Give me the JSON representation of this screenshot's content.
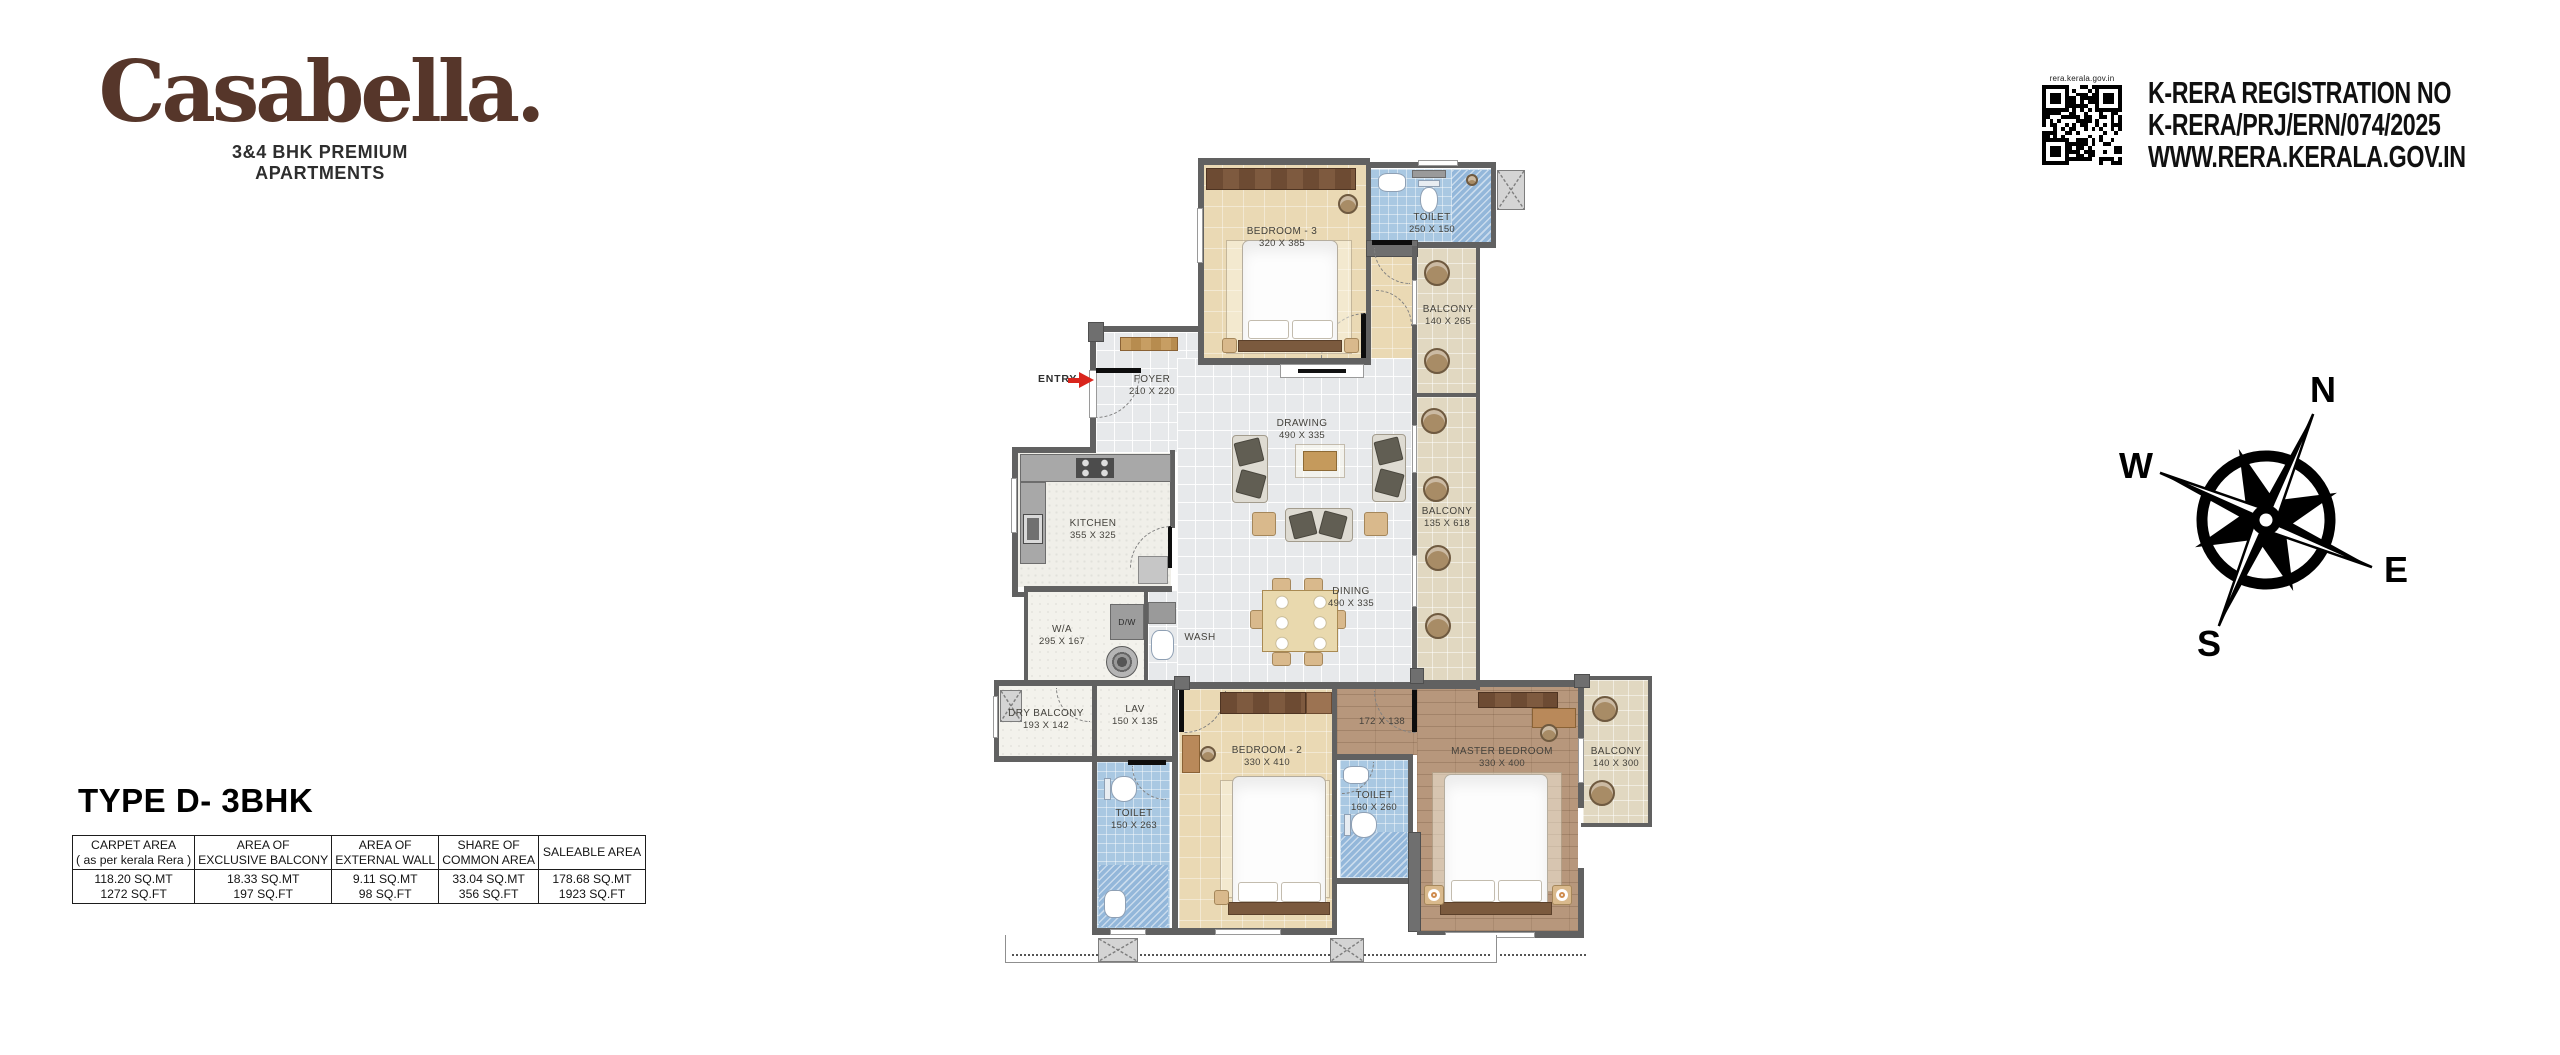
{
  "brand": {
    "logo": "Casabella.",
    "tagline1": "3&4 BHK PREMIUM",
    "tagline2": "APARTMENTS"
  },
  "rera": {
    "qr_caption": "rera.kerala.gov.in",
    "line1": "K-RERA REGISTRATION NO",
    "line2": "K-RERA/PRJ/ERN/074/2025",
    "line3": "WWW.RERA.KERALA.GOV.IN"
  },
  "compass": {
    "n": "N",
    "e": "E",
    "s": "S",
    "w": "W"
  },
  "plan_title": "TYPE D- 3BHK",
  "area_table": {
    "headers": [
      [
        "CARPET AREA",
        "( as per kerala Rera )"
      ],
      [
        "AREA OF",
        "EXCLUSIVE BALCONY"
      ],
      [
        "AREA OF",
        "EXTERNAL WALL"
      ],
      [
        "SHARE OF",
        "COMMON AREA"
      ],
      [
        "SALEABLE AREA",
        ""
      ]
    ],
    "values": [
      [
        "118.20 SQ.MT",
        "1272 SQ.FT"
      ],
      [
        "18.33 SQ.MT",
        "197 SQ.FT"
      ],
      [
        "9.11 SQ.MT",
        "98 SQ.FT"
      ],
      [
        "33.04 SQ.MT",
        "356 SQ.FT"
      ],
      [
        "178.68 SQ.MT",
        "1923 SQ.FT"
      ]
    ]
  },
  "rooms": {
    "bedroom3": {
      "name": "BEDROOM - 3",
      "dims": "320 X 385"
    },
    "toilet_top": {
      "name": "TOILET",
      "dims": "250 X 150"
    },
    "balcony_top": {
      "name": "BALCONY",
      "dims": "140 X 265"
    },
    "foyer": {
      "name": "FOYER",
      "dims": "210 X 220"
    },
    "drawing": {
      "name": "DRAWING",
      "dims": "490 X 335"
    },
    "dining": {
      "name": "DINING",
      "dims": "490 X 335"
    },
    "balcony_right": {
      "name": "BALCONY",
      "dims": "135 X 618"
    },
    "kitchen": {
      "name": "KITCHEN",
      "dims": "355 X 325"
    },
    "work_area": {
      "name": "W/A",
      "dims": "295 X 167"
    },
    "dry_balcony": {
      "name": "DRY BALCONY",
      "dims": "193 X 142"
    },
    "lav": {
      "name": "LAV",
      "dims": "150 X 135"
    },
    "toilet_bed2": {
      "name": "TOILET",
      "dims": "150 X 263"
    },
    "bedroom2": {
      "name": "BEDROOM - 2",
      "dims": "330 X 410"
    },
    "toilet_master": {
      "name": "TOILET",
      "dims": "160 X 260"
    },
    "passage": {
      "dims": "172 X 138"
    },
    "master": {
      "name": "MASTER BEDROOM",
      "dims": "330 X 400"
    },
    "balcony_master": {
      "name": "BALCONY",
      "dims": "140 X 300"
    },
    "entry": {
      "label": "ENTRY"
    },
    "dw": {
      "label": "D/W"
    },
    "wash": {
      "label": "WASH"
    }
  }
}
